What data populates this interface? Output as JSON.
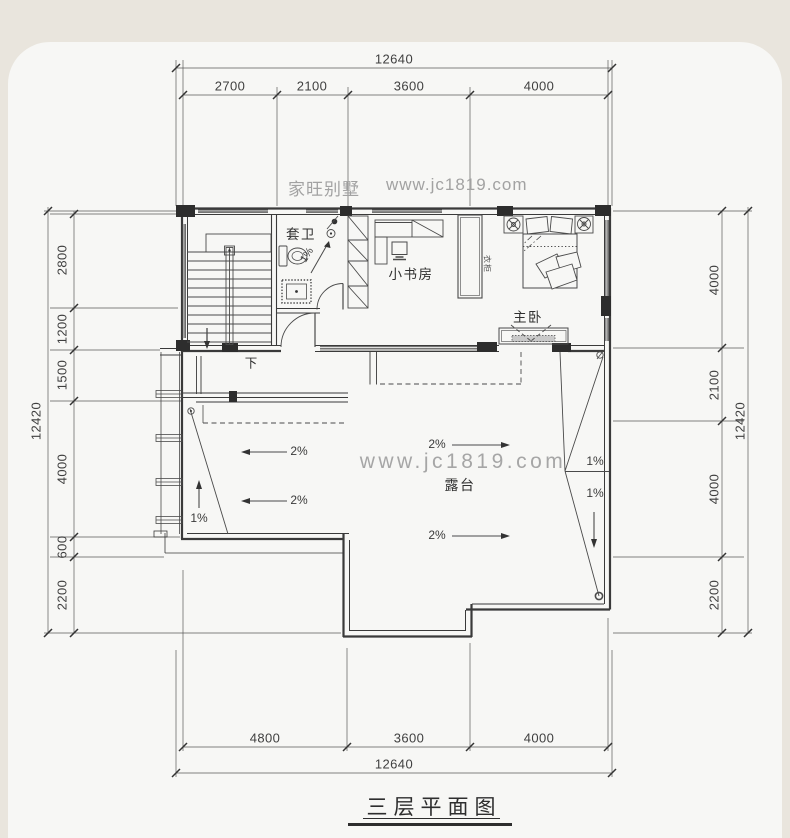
{
  "title": "三层平面图",
  "watermarks": {
    "brand": "家旺别墅",
    "site": "www.jc1819.com",
    "site_center": "www.jc1819.com"
  },
  "rooms": {
    "bathroom": "套卫",
    "study": "小书房",
    "master_bedroom": "主卧",
    "terrace": "露台",
    "stair_down": "下",
    "wardrobe": "衣柜"
  },
  "slopes": {
    "two_percent": "2%",
    "one_percent": "1%"
  },
  "dims": {
    "top": {
      "total": "12640",
      "segments": [
        "2700",
        "2100",
        "3600",
        "4000"
      ]
    },
    "bottom": {
      "total": "12640",
      "segments": [
        "4800",
        "3600",
        "4000"
      ]
    },
    "left": {
      "total": "12420",
      "segments": [
        "2800",
        "1200",
        "1500",
        "4000",
        "600",
        "2200"
      ]
    },
    "right": {
      "total": "12420",
      "segments": [
        "4000",
        "2100",
        "4000",
        "2200"
      ]
    }
  },
  "colors": {
    "page_bg": "#e9e5dd",
    "canvas": "#f7f7f5",
    "line": "#3a3a3a",
    "watermark": "#a2a2a2"
  }
}
